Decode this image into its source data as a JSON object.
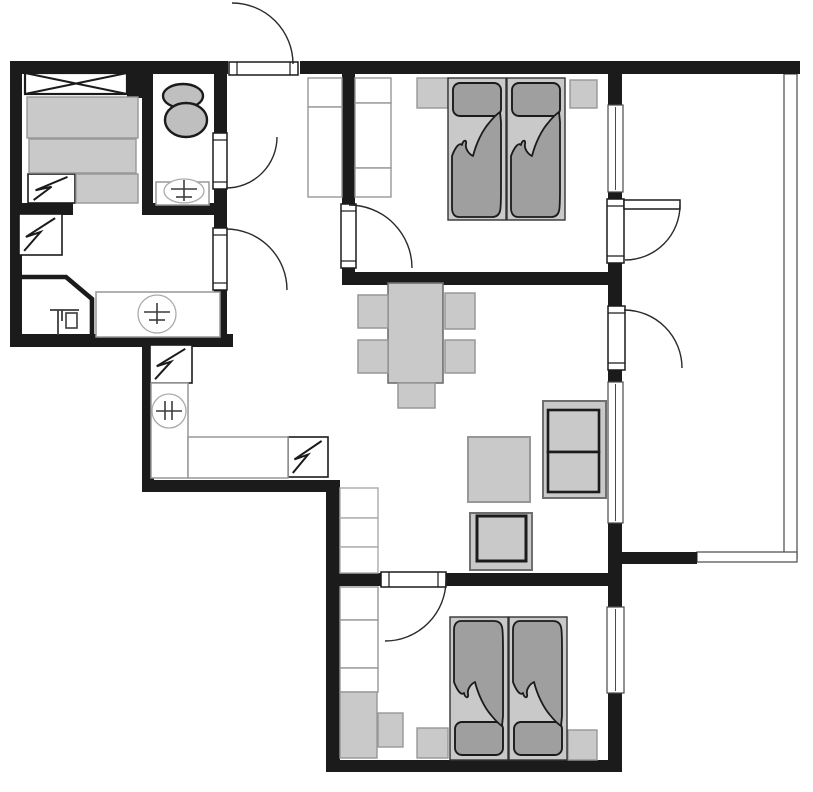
{
  "canvas": {
    "w": 813,
    "h": 792,
    "bg": "#ffffff"
  },
  "palette": {
    "wall": "#1b1b1b",
    "furniture_light": "#c9c9c9",
    "furniture_mid": "#9f9f9f",
    "fixture_gray": "#bfbfbf",
    "outline_dark": "#1b1b1b",
    "outline_med": "#6f6f6f",
    "outline_soft": "#979797",
    "outline_faint": "#aaaaaa",
    "window_frame": "#4a4a4a",
    "railing": "#565656",
    "symbol": "#3c3c3c",
    "white": "#ffffff"
  },
  "plan": {
    "walls": [
      {
        "n": "wall-top-left-block",
        "r": [
          10,
          61,
          218,
          13
        ]
      },
      {
        "n": "wall-left-outer",
        "r": [
          10,
          61,
          12,
          286
        ]
      },
      {
        "n": "wall-left-block-bottom",
        "r": [
          10,
          334,
          223,
          13
        ]
      },
      {
        "n": "wall-left-block-right-upper",
        "r": [
          214,
          61,
          13,
          74
        ]
      },
      {
        "n": "wall-left-block-right-mid",
        "r": [
          214,
          188,
          13,
          40
        ]
      },
      {
        "n": "wall-left-block-right-lower",
        "r": [
          214,
          290,
          13,
          57
        ]
      },
      {
        "n": "wall-bathroom-left",
        "r": [
          142,
          70,
          11,
          145
        ]
      },
      {
        "n": "wall-bathroom-bottom",
        "r": [
          142,
          203,
          85,
          12
        ]
      },
      {
        "n": "wall-storage-stub",
        "r": [
          10,
          203,
          63,
          12
        ]
      },
      {
        "n": "wall-closet-post",
        "r": [
          127,
          70,
          15,
          28
        ]
      },
      {
        "n": "wall-top-main",
        "r": [
          300,
          61,
          500,
          13
        ]
      },
      {
        "n": "wall-bedroom1-left",
        "r": [
          342,
          61,
          13,
          144
        ]
      },
      {
        "n": "wall-bedroom1-left-tip",
        "r": [
          342,
          267,
          13,
          8
        ]
      },
      {
        "n": "wall-bedroom1-bottom",
        "r": [
          342,
          272,
          278,
          13
        ]
      },
      {
        "n": "wall-right-upper",
        "r": [
          608,
          74,
          14,
          31
        ]
      },
      {
        "n": "wall-right-between-window-door",
        "r": [
          608,
          192,
          14,
          10
        ]
      },
      {
        "n": "wall-right-mid-junction",
        "r": [
          608,
          259,
          14,
          49
        ]
      },
      {
        "n": "wall-right-below-door2",
        "r": [
          608,
          370,
          14,
          12
        ]
      },
      {
        "n": "wall-right-living-lower",
        "r": [
          608,
          523,
          14,
          84
        ]
      },
      {
        "n": "wall-right-bedroom2-lower",
        "r": [
          608,
          693,
          14,
          79
        ]
      },
      {
        "n": "wall-corridor-left",
        "r": [
          142,
          334,
          12,
          158
        ]
      },
      {
        "n": "wall-kitchen-bottom",
        "r": [
          142,
          480,
          196,
          12
        ]
      },
      {
        "n": "wall-bedroom2-left",
        "r": [
          326,
          480,
          14,
          292
        ]
      },
      {
        "n": "wall-bedroom2-top-a",
        "r": [
          326,
          573,
          56,
          13
        ]
      },
      {
        "n": "wall-bedroom2-top-b",
        "r": [
          445,
          573,
          175,
          13
        ]
      },
      {
        "n": "wall-bottom-outer",
        "r": [
          326,
          760,
          296,
          12
        ]
      },
      {
        "n": "wall-balcony-stub",
        "r": [
          620,
          552,
          77,
          12
        ]
      }
    ],
    "shower_enclosure": {
      "n": "shower-corner-wall",
      "points": "20,277 66,277 92,299 92,339",
      "stroke_w": 4.6
    },
    "railings": [
      {
        "n": "balcony-railing-right",
        "r": [
          784,
          74,
          13,
          484
        ]
      },
      {
        "n": "balcony-railing-bottom",
        "r": [
          697,
          552,
          100,
          10
        ]
      }
    ],
    "windows": [
      {
        "n": "window-bedroom1",
        "r": [
          608,
          105,
          15,
          87
        ]
      },
      {
        "n": "window-living",
        "r": [
          608,
          382,
          15,
          141
        ]
      },
      {
        "n": "window-bedroom2",
        "r": [
          607,
          607,
          17,
          86
        ]
      }
    ],
    "door_leaves": [
      {
        "n": "entry-door-leaf",
        "r": [
          229,
          62,
          69,
          13
        ],
        "dir": "h"
      },
      {
        "n": "bathroom-door-leaf",
        "r": [
          213,
          133,
          14,
          56
        ],
        "dir": "v"
      },
      {
        "n": "storage-door-leaf",
        "r": [
          213,
          228,
          14,
          62
        ],
        "dir": "v"
      },
      {
        "n": "bedroom1-door-leaf",
        "r": [
          341,
          204,
          15,
          64
        ],
        "dir": "v"
      },
      {
        "n": "balcony-door1-opening",
        "r": [
          607,
          199,
          17,
          64
        ],
        "dir": "v"
      },
      {
        "n": "balcony-door1-leaf",
        "r": [
          624,
          200,
          56,
          9
        ],
        "dir": "none"
      },
      {
        "n": "balcony-door2-opening",
        "r": [
          608,
          306,
          17,
          64
        ],
        "dir": "v"
      },
      {
        "n": "bedroom2-door-leaf",
        "r": [
          381,
          572,
          65,
          15
        ],
        "dir": "h"
      }
    ],
    "door_arcs": [
      {
        "n": "entry-door-swing",
        "d": "M 232,3 A 61,61 0 0 1 293,64"
      },
      {
        "n": "bathroom-door-swing",
        "d": "M 226,188 A 51,51 0 0 0 277,137"
      },
      {
        "n": "storage-door-swing",
        "d": "M 226,229 A 61,61 0 0 1 287,290"
      },
      {
        "n": "bedroom1-door-swing",
        "d": "M 349,205 A 63,63 0 0 1 412,268"
      },
      {
        "n": "balcony-door1-swing",
        "d": "M 680,205 A 55,55 0 0 1 625,260"
      },
      {
        "n": "balcony-door2-swing",
        "d": "M 624,310 A 58,58 0 0 1 682,368"
      },
      {
        "n": "bedroom2-door-swing",
        "d": "M 446,580 A 61,61 0 0 1 385,641"
      }
    ],
    "closet_x": {
      "n": "storage-closet",
      "r": [
        25,
        73,
        102,
        21
      ]
    },
    "appliances": [
      {
        "n": "storage-appliance-1",
        "r": [
          28,
          174,
          47,
          29
        ]
      },
      {
        "n": "storage-appliance-2",
        "r": [
          19,
          214,
          43,
          41
        ]
      },
      {
        "n": "kitchen-appliance-1",
        "r": [
          150,
          345,
          42,
          38
        ]
      },
      {
        "n": "kitchen-appliance-2",
        "r": [
          288,
          437,
          40,
          40
        ]
      }
    ],
    "rects": [
      {
        "n": "storage-bed-part-1",
        "r": [
          27,
          97,
          111,
          41
        ],
        "f": "furniture_light",
        "s": "outline_soft",
        "w": 1.4
      },
      {
        "n": "storage-bed-part-2",
        "r": [
          29,
          139,
          107,
          34
        ],
        "f": "furniture_light",
        "s": "outline_soft",
        "w": 1.4
      },
      {
        "n": "storage-bed-part-3",
        "r": [
          76,
          174,
          62,
          29
        ],
        "f": "furniture_light",
        "s": "outline_soft",
        "w": 1.4
      },
      {
        "n": "storage-counter",
        "r": [
          96,
          292,
          124,
          45
        ],
        "f": "white",
        "s": "outline_soft",
        "w": 1.5
      },
      {
        "n": "bathroom-sink-counter",
        "r": [
          156,
          182,
          53,
          23
        ],
        "f": "white",
        "s": "outline_soft",
        "w": 1.5
      },
      {
        "n": "hall-wardrobe-left-1",
        "r": [
          308,
          78,
          34,
          29
        ],
        "f": "white",
        "s": "outline_soft",
        "w": 1.4
      },
      {
        "n": "hall-wardrobe-left-2",
        "r": [
          308,
          107,
          34,
          90
        ],
        "f": "white",
        "s": "outline_soft",
        "w": 1.4
      },
      {
        "n": "hall-wardrobe-right-1",
        "r": [
          355,
          78,
          36,
          25
        ],
        "f": "white",
        "s": "outline_soft",
        "w": 1.4
      },
      {
        "n": "hall-wardrobe-right-2",
        "r": [
          355,
          103,
          36,
          65
        ],
        "f": "white",
        "s": "outline_soft",
        "w": 1.4
      },
      {
        "n": "hall-wardrobe-right-3",
        "r": [
          355,
          168,
          36,
          29
        ],
        "f": "white",
        "s": "outline_soft",
        "w": 1.4
      },
      {
        "n": "kitchen-counter-vertical",
        "r": [
          151,
          383,
          37,
          95
        ],
        "f": "white",
        "s": "outline_soft",
        "w": 1.5
      },
      {
        "n": "kitchen-counter-horizontal",
        "r": [
          188,
          437,
          100,
          41
        ],
        "f": "white",
        "s": "outline_soft",
        "w": 1.5
      },
      {
        "n": "bedroom1-nightstand-left",
        "r": [
          417,
          78,
          31,
          30
        ],
        "f": "furniture_light",
        "s": "outline_soft",
        "w": 1.4
      },
      {
        "n": "bedroom1-nightstand-right",
        "r": [
          570,
          80,
          27,
          28
        ],
        "f": "furniture_light",
        "s": "outline_soft",
        "w": 1.4
      },
      {
        "n": "living-shelf-1",
        "r": [
          340,
          488,
          38,
          30
        ],
        "f": "white",
        "s": "outline_faint",
        "w": 1.4
      },
      {
        "n": "living-shelf-2",
        "r": [
          340,
          518,
          38,
          29
        ],
        "f": "white",
        "s": "outline_faint",
        "w": 1.4
      },
      {
        "n": "living-shelf-3",
        "r": [
          340,
          547,
          38,
          26
        ],
        "f": "white",
        "s": "outline_faint",
        "w": 1.4
      },
      {
        "n": "dining-table",
        "r": [
          388,
          283,
          55,
          100
        ],
        "f": "furniture_light",
        "s": "outline_med",
        "w": 1.6
      },
      {
        "n": "dining-chair-left-top",
        "r": [
          358,
          295,
          30,
          33
        ],
        "f": "furniture_light",
        "s": "outline_soft",
        "w": 1.5
      },
      {
        "n": "dining-chair-left-bottom",
        "r": [
          358,
          340,
          30,
          33
        ],
        "f": "furniture_light",
        "s": "outline_soft",
        "w": 1.5
      },
      {
        "n": "dining-chair-right-top",
        "r": [
          445,
          293,
          30,
          36
        ],
        "f": "furniture_light",
        "s": "outline_soft",
        "w": 1.5
      },
      {
        "n": "dining-chair-right-bottom",
        "r": [
          445,
          340,
          30,
          33
        ],
        "f": "furniture_light",
        "s": "outline_soft",
        "w": 1.5
      },
      {
        "n": "dining-chair-bottom",
        "r": [
          398,
          383,
          37,
          25
        ],
        "f": "furniture_light",
        "s": "outline_soft",
        "w": 1.5
      },
      {
        "n": "living-rug",
        "r": [
          468,
          437,
          62,
          65
        ],
        "f": "furniture_light",
        "s": "outline_soft",
        "w": 2
      },
      {
        "n": "sofa-body",
        "r": [
          543,
          401,
          63,
          97
        ],
        "f": "furniture_light",
        "s": "outline_med",
        "w": 2
      },
      {
        "n": "sofa-cushion-top",
        "r": [
          548,
          410,
          51,
          42
        ],
        "f": "furniture_light",
        "s": "outline_dark",
        "w": 2.6
      },
      {
        "n": "sofa-cushion-bottom",
        "r": [
          548,
          452,
          51,
          40
        ],
        "f": "furniture_light",
        "s": "outline_dark",
        "w": 2.6
      },
      {
        "n": "armchair-body",
        "r": [
          470,
          513,
          62,
          57
        ],
        "f": "furniture_light",
        "s": "outline_med",
        "w": 2
      },
      {
        "n": "armchair-cushion",
        "r": [
          477,
          516,
          49,
          45
        ],
        "f": "furniture_light",
        "s": "outline_dark",
        "w": 3
      },
      {
        "n": "bedroom2-wardrobe-1",
        "r": [
          340,
          587,
          38,
          33
        ],
        "f": "white",
        "s": "outline_soft",
        "w": 1.4
      },
      {
        "n": "bedroom2-wardrobe-2",
        "r": [
          340,
          620,
          38,
          48
        ],
        "f": "white",
        "s": "outline_soft",
        "w": 1.4
      },
      {
        "n": "bedroom2-wardrobe-3",
        "r": [
          340,
          668,
          38,
          24
        ],
        "f": "white",
        "s": "outline_soft",
        "w": 1.4
      },
      {
        "n": "bedroom2-dresser",
        "r": [
          340,
          692,
          37,
          66
        ],
        "f": "furniture_light",
        "s": "outline_soft",
        "w": 1.4
      },
      {
        "n": "bedroom2-side-table",
        "r": [
          378,
          713,
          25,
          34
        ],
        "f": "furniture_light",
        "s": "outline_soft",
        "w": 1.4
      },
      {
        "n": "bedroom2-nightstand-left",
        "r": [
          417,
          728,
          31,
          30
        ],
        "f": "furniture_light",
        "s": "outline_soft",
        "w": 1.4
      },
      {
        "n": "bedroom2-nightstand-right",
        "r": [
          568,
          730,
          29,
          30
        ],
        "f": "furniture_light",
        "s": "outline_soft",
        "w": 1.4
      }
    ],
    "beds": [
      {
        "n": "bedroom1-bed-left",
        "x": 448,
        "y": 78,
        "w": 58,
        "h": 142,
        "head": "top"
      },
      {
        "n": "bedroom1-bed-right",
        "x": 507,
        "y": 78,
        "w": 58,
        "h": 142,
        "head": "top"
      },
      {
        "n": "bedroom2-bed-left",
        "x": 450,
        "y": 617,
        "w": 58,
        "h": 143,
        "head": "bottom"
      },
      {
        "n": "bedroom2-bed-right",
        "x": 509,
        "y": 617,
        "w": 58,
        "h": 143,
        "head": "bottom"
      }
    ],
    "bed_parts": {
      "pillow": {
        "inset_x": 5,
        "inset_y": 5,
        "h": 33,
        "rx": 7
      },
      "blanket_path": "M4,78 C7,70 11,64 14,67 C15,62 19,61 18,66 C17,71 21,76 25,78 C28,66 34,53 41,45 C45,40 49,36 52,34 L53,44 L53,110 C53,122 53,130 52,133 C51,137 48,139 44,139 L11,139 C7,139 4,136 4,130 Z"
    },
    "fixtures": {
      "toilet_tank": {
        "n": "toilet-tank",
        "cx": 183,
        "cy": 96,
        "rx": 20,
        "ry": 12
      },
      "toilet_bowl": {
        "n": "toilet-bowl",
        "cx": 186,
        "cy": 120,
        "rx": 21,
        "ry": 17
      },
      "bath_sink": {
        "n": "bathroom-sink-basin",
        "cx": 184,
        "cy": 191,
        "rx": 20,
        "ry": 12
      },
      "counter_sink": {
        "n": "storage-sink-basin",
        "cx": 157,
        "cy": 314,
        "rx": 19,
        "ry": 19
      },
      "kitchen_hob": {
        "n": "kitchen-hob",
        "cx": 169,
        "cy": 411,
        "rx": 17,
        "ry": 17
      },
      "shower_tap": {
        "n": "shower-tap",
        "lines": [
          [
            50,
            310,
            79,
            310
          ],
          [
            58,
            310,
            58,
            335
          ],
          [
            62,
            310,
            62,
            321
          ]
        ],
        "box": [
          66,
          313,
          11,
          15
        ]
      }
    }
  }
}
